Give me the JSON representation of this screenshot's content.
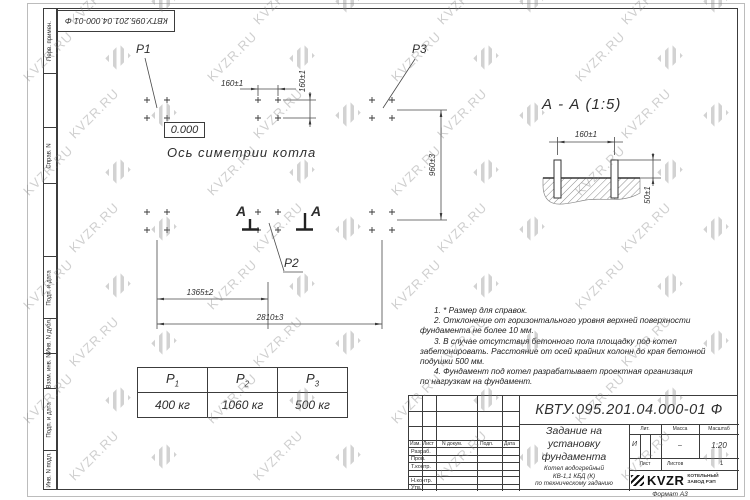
{
  "page": {
    "format_label": "Формат А3"
  },
  "top_stamp": {
    "text": "КВТУ.095.201.04.000-01  Ф"
  },
  "margins": {
    "labels": [
      "Перв. примен.",
      "Справ. N",
      "Подп. и дата",
      "Инв. N дубл.",
      "Взам. инв. N",
      "Подп. и дата",
      "Инв. N подл."
    ]
  },
  "plan": {
    "p1": "P1",
    "p2": "P2",
    "p3": "P3",
    "elevation": "0.000",
    "axis_label": "Ось симетрии котла",
    "cut_letter": "А"
  },
  "section": {
    "title": "А - А (1:5)"
  },
  "dims": {
    "plan_bolt_spacing_x": "160±1",
    "plan_bolt_spacing_y": "160±1",
    "plan_height": "960±3",
    "plan_half_length": "1365±2",
    "plan_full_length": "2810±3",
    "section_bolt_spacing": "160±1",
    "section_bolt_height": "50±1"
  },
  "loads_table": {
    "headers": [
      {
        "base": "P",
        "sub": "1"
      },
      {
        "base": "P",
        "sub": "2"
      },
      {
        "base": "P",
        "sub": "3"
      }
    ],
    "values": [
      "400 кг",
      "1060 кг",
      "500 кг"
    ]
  },
  "notes": {
    "lines": [
      "1. * Размер для справок.",
      "2. Отклонение от горизонтального уровня верхней поверхности",
      "фундамента не более 10 мм.",
      "3. В случае отсутствия бетонного пола площадку под котел",
      "забетонировать. Расстояние от осей крайних колонн до края бетонной",
      "подушки 500 мм.",
      "4. Фундамент под котел разрабатывает проектная организация",
      "по нагрузкам на фундамент."
    ]
  },
  "title_block": {
    "doc_number": "КВТУ.095.201.04.000-01  Ф",
    "title_lines": [
      "Задание на",
      "установку",
      "фундамента"
    ],
    "product_lines": [
      "Котел водогрейный",
      "КВ-1,1 КБД (К)",
      "по техническому заданию"
    ],
    "col_izm": "Изм.",
    "col_list": "Лист",
    "col_doc": "N докум.",
    "col_podp": "Подп.",
    "col_data": "Дата",
    "row_razrab": "Разраб.",
    "row_prov": "Пров.",
    "row_tkontr": "Т.контр.",
    "row_nkontr": "Н.контр.",
    "row_utv": "Утв.",
    "lit_label": "Лит.",
    "lit_value": "И",
    "mass_label": "Масса",
    "mass_value": "–",
    "scale_label": "Масштаб",
    "scale_value": "1:20",
    "sheet_label": "Лист",
    "sheets_label": "Листов",
    "sheets_value": "1",
    "logo_text": "KVZR",
    "logo_caption": [
      "КОТЕЛЬНЫЙ",
      "ЗАВОД РЭП"
    ]
  },
  "watermark": {
    "text": "KVZR.RU"
  },
  "colors": {
    "line": "#3c3c3c",
    "watermark": "#c6c6c6"
  }
}
